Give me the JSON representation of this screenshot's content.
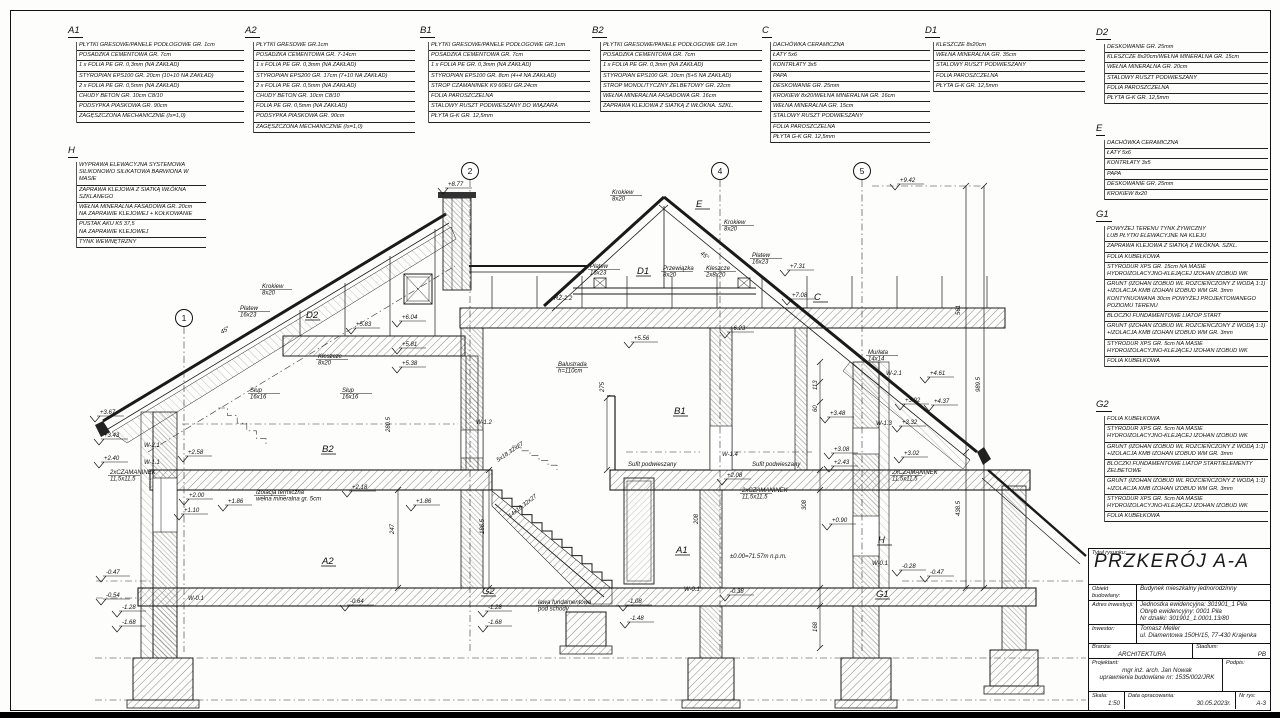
{
  "sheet": {
    "type": "architectural-section-drawing"
  },
  "blocks": [
    {
      "id": "A1",
      "x": 68,
      "y": 26,
      "w": 176,
      "rows": [
        [
          "PŁYTKI GRESOWE/PANELE PODŁOGOWE GR. 1cm"
        ],
        [
          "POSADZKA CEMENTOWA GR. 7cm"
        ],
        [
          "1 x FOLIA PE GR. 0,3mm (NA ZAKŁAD)"
        ],
        [
          "STYROPIAN EPS100 GR. 20cm (10+10 NA ZAKŁAD)"
        ],
        [
          "2 x FOLIA PE GR. 0,5mm (NA ZAKŁAD)"
        ],
        [
          "CHUDY BETON GR. 10cm C8/10"
        ],
        [
          "PODSYPKA PIASKOWA GR. 90cm"
        ],
        [
          "ZAGĘSZCZONA MECHANICZNIE (Is=1,0)"
        ]
      ]
    },
    {
      "id": "A2",
      "x": 245,
      "y": 26,
      "w": 170,
      "rows": [
        [
          "PŁYTKI GRESOWE GR.1cm"
        ],
        [
          "POSADZKA CEMENTOWA GR. 7-14cm"
        ],
        [
          "1 x FOLIA PE GR. 0,3mm (NA ZAKŁAD)"
        ],
        [
          "STYROPIAN EPS200 GR. 17cm (7+10 NA ZAKŁAD)"
        ],
        [
          "2 x FOLIA PE GR. 0,5mm (NA ZAKŁAD)"
        ],
        [
          "CHUDY BETON GR. 10cm C8/10"
        ],
        [
          "FOLIA PE GR. 0,5mm (NA ZAKŁAD)"
        ],
        [
          "PODSYPKA PIASKOWA GR. 90cm"
        ],
        [
          "ZAGĘSZCZONA MECHANICZNIE (Is=1,0)"
        ]
      ]
    },
    {
      "id": "B1",
      "x": 420,
      "y": 26,
      "w": 170,
      "rows": [
        [
          "PŁYTKI GRESOWE/PANELE PODŁOGOWE GR.1cm"
        ],
        [
          "POSADZKA CEMENTOWA GR. 7cm"
        ],
        [
          "1 x FOLIA PE GR. 0,3mm (NA ZAKŁAD)"
        ],
        [
          "STYROPIAN EPS100 GR. 8cm (4+4 NA ZAKŁAD)"
        ],
        [
          "STROP CZAMANINEK K9 60EU GR.24cm"
        ],
        [
          "FOLIA PAROSZCZELNA"
        ],
        [
          "STALOWY RUSZT PODWIESZANY DO WIĄZARA"
        ],
        [
          "PŁYTA G-K GR. 12,5mm"
        ]
      ]
    },
    {
      "id": "B2",
      "x": 592,
      "y": 26,
      "w": 170,
      "rows": [
        [
          "PŁYTKI GRESOWE/PANELE PODŁOGOWE GR.1cm"
        ],
        [
          "POSADZKA CEMENTOWA GR. 7cm"
        ],
        [
          "1 x FOLIA PE GR. 0,3mm (NA ZAKŁAD)"
        ],
        [
          "STYROPIAN EPS100 GR. 10cm (5+5 NA ZAKŁAD)"
        ],
        [
          "STROP MONOLITYCZNY ŻELBETOWY GR. 22cm"
        ],
        [
          "WEŁNA MINERALNA FASADOWA GR. 16cm"
        ],
        [
          "ZAPRAWA KLEJOWA Z SIATKĄ Z WŁÓKNA. SZKL."
        ]
      ]
    },
    {
      "id": "C",
      "x": 762,
      "y": 26,
      "w": 168,
      "rows": [
        [
          "DACHÓWKA CERAMICZNA"
        ],
        [
          "ŁATY 5x6"
        ],
        [
          "KONTRŁATY 3x5"
        ],
        [
          "PAPA"
        ],
        [
          "DESKOWANIE GR. 25mm"
        ],
        [
          "KROKIEW 8x20/WEŁNA MINERALNA GR. 16cm"
        ],
        [
          "WEŁNA MINERALNA GR. 15cm"
        ],
        [
          "STALOWY RUSZT PODWIESZANY"
        ],
        [
          "FOLIA PAROSZCZELNA"
        ],
        [
          "PŁYTA G-K GR. 12,5mm"
        ]
      ]
    },
    {
      "id": "D1",
      "x": 925,
      "y": 26,
      "w": 160,
      "rows": [
        [
          "KLESZCZE 8x20cm"
        ],
        [
          "WEŁNA MINERALNA GR. 35cm"
        ],
        [
          "STALOWY RUSZT PODWIESZANY"
        ],
        [
          "FOLIA PAROSZCZELNA"
        ],
        [
          "PŁYTA G-K GR. 12,5mm"
        ]
      ]
    },
    {
      "id": "D2",
      "x": 1096,
      "y": 28,
      "w": 172,
      "rows": [
        [
          "DESKOWANIE GR. 25mm"
        ],
        [
          "KLESZCZE 8x20cm/WEŁNA MINERALNA GR. 15cm"
        ],
        [
          "WEŁNA MINERALNA GR. 20cm"
        ],
        [
          "STALOWY RUSZT PODWIESZANY"
        ],
        [
          "FOLIA PAROSZCZELNA"
        ],
        [
          "PŁYTA G-K GR. 12,5mm"
        ]
      ]
    },
    {
      "id": "E",
      "x": 1096,
      "y": 124,
      "w": 172,
      "rows": [
        [
          "DACHÓWKA CERAMICZNA"
        ],
        [
          "ŁATY 5x6"
        ],
        [
          "KONTRŁATY 3x5"
        ],
        [
          "PAPA"
        ],
        [
          "DESKOWANIE GR. 25mm"
        ],
        [
          "KROKIEW 8x20"
        ]
      ]
    },
    {
      "id": "G1",
      "x": 1096,
      "y": 210,
      "w": 172,
      "rows": [
        [
          "POWYŻEJ TERENU TYNK ŻYWICZNY",
          "LUB PŁYTKI ELEWACYJNE NA KLEJU"
        ],
        [
          "ZAPRAWA KLEJOWA Z SIATKĄ Z WŁÓKNA. SZKL."
        ],
        [
          "FOLIA KUBEŁKOWA"
        ],
        [
          "STYRODUR XPS GR. 15cm NA MASIE",
          "HYDROIZOLACYJNO-KLEJĄCEJ IZOHAN IZOBUD WK"
        ],
        [
          "GRUNT (IZOHAN IZOBUD WL ROZCIEŃCZONY Z WODĄ 1:1)",
          "+IZOLACJA KMB IZOHAN IZOBUD WM  GR. 3mm",
          "KONTYNUOWANA 30cm POWYŻEJ PROJEKTOWANEGO",
          "POZIOMU TERENU"
        ],
        [
          "BLOCZKI FUNDAMENTOWE LIATOP START"
        ],
        [
          "GRUNT (IZOHAN IZOBUD WL ROZCIEŃCZONY Z WODĄ 1:1)",
          "+IZOLACJA KMB IZOHAN IZOBUD WM  GR. 3mm"
        ],
        [
          "STYRODUR XPS GR. 5cm NA MASIE",
          "HYDROIZOLACYJNO-KLEJĄCEJ IZOHAN IZOBUD WK"
        ],
        [
          "FOLIA KUBEŁKOWA"
        ]
      ]
    },
    {
      "id": "G2",
      "x": 1096,
      "y": 400,
      "w": 172,
      "rows": [
        [
          "FOLIA KUBEŁKOWA"
        ],
        [
          "STYRODUR XPS GR. 5cm NA MASIE",
          "HYDROIZOLACYJNO-KLEJĄCEJ IZOHAN IZOBUD WK"
        ],
        [
          "GRUNT (IZOHAN IZOBUD WL ROZCIEŃCZONY Z WODĄ 1:1)",
          "+IZOLACJA KMB IZOHAN IZOBUD WM  GR. 3mm"
        ],
        [
          "BLOCZKI FUNDAMENTOWE LIATOP START/ELEMENTY ŻELBETOWE"
        ],
        [
          "GRUNT (IZOHAN IZOBUD WL ROZCIEŃCZONY Z WODĄ 1:1)",
          "+IZOLACJA KMB IZOHAN IZOBUD WM  GR. 3mm"
        ],
        [
          "STYRODUR XPS GR. 5cm NA MASIE",
          "HYDROIZOLACYJNO-KLEJĄCEJ IZOHAN IZOBUD WK"
        ],
        [
          "FOLIA KUBEŁKOWA"
        ]
      ]
    },
    {
      "id": "H",
      "x": 68,
      "y": 146,
      "w": 138,
      "rows": [
        [
          "WYPRAWA ELEWACYJNA SYSTEMOWA",
          "SILIKONOWO SILIKATOWA BARWIONA W MASIE"
        ],
        [
          "ZAPRAWA KLEJOWA Z SIATKĄ WŁÓKNA SZKLANEGO"
        ],
        [
          "WEŁNA MINERALNA FASADOWA GR. 20cm",
          "NA ZAPRAWIE KLEJOWEJ + KOŁKOWANIE"
        ],
        [
          "PUSTAK AKU K5 37,5",
          "NA ZAPRAWIE KLEJOWEJ"
        ],
        [
          "TYNK WEWNĘTRZNY"
        ]
      ]
    }
  ],
  "titleblock": {
    "drawing_title_label": "Tytuł rysunku:",
    "drawing_title": "PRZKERÓJ A-A",
    "object_label": "Obiekt budowlany:",
    "object_value": "Budynek mieszkalny jednorodzinny",
    "address_label": "Adres inwestycji:",
    "address_lines": [
      "Jednostka ewidencyjna: 301901_1 Piła",
      "Obręb ewidencyjny: 0001 Piła",
      "Nr działki: 301901_1.0001.13/80"
    ],
    "investor_label": "Inwestor:",
    "investor_lines": [
      "Tomasz Meller",
      "ul. Diamentowa 150H/15, 77-430 Krajenka"
    ],
    "branch_label": "Branża:",
    "branch_value": "ARCHITEKTURA",
    "stage_label": "Stadium:",
    "stage_value": "PB",
    "designer_label": "Projektant:",
    "designer_lines": [
      "mgr inż. arch. Jan Nowak",
      "uprawnienia budowlane nr: 1535/002/JRK"
    ],
    "signature_label": "Podpis:",
    "scale_label": "Skala:",
    "scale_value": "1:50",
    "date_label": "Data opracowania:",
    "date_value": "30.05.2023r.",
    "sheet_no_label": "Nr rys:",
    "sheet_no_value": "A-3"
  },
  "drawing": {
    "grid": [
      {
        "n": "1",
        "x": 184,
        "y": 318
      },
      {
        "n": "2",
        "x": 470,
        "y": 171
      },
      {
        "n": "4",
        "x": 720,
        "y": 171
      },
      {
        "n": "5",
        "x": 862,
        "y": 171
      }
    ],
    "labels": [
      {
        "t": "+9.42",
        "x": 900,
        "y": 182,
        "e": 1
      },
      {
        "t": "+8.77",
        "x": 448,
        "y": 186,
        "e": 1
      },
      {
        "l": [
          "Krokiew",
          "8x20"
        ],
        "x": 262,
        "y": 288
      },
      {
        "l": [
          "Płatew",
          "16x23"
        ],
        "x": 240,
        "y": 310
      },
      {
        "t": "45°",
        "x": 222,
        "y": 334,
        "r": -31
      },
      {
        "t": "D2",
        "x": 306,
        "y": 318,
        "b": 1
      },
      {
        "t": "+6.04",
        "x": 402,
        "y": 319,
        "e": 1
      },
      {
        "t": "+5.83",
        "x": 356,
        "y": 326,
        "e": 1
      },
      {
        "t": "+5.81",
        "x": 402,
        "y": 346,
        "e": 1
      },
      {
        "t": "+5.38",
        "x": 402,
        "y": 365,
        "e": 1
      },
      {
        "l": [
          "Kleszcze",
          "8x20"
        ],
        "x": 318,
        "y": 358
      },
      {
        "l": [
          "Słup",
          "16x16"
        ],
        "x": 250,
        "y": 392
      },
      {
        "l": [
          "Słup",
          "16x16"
        ],
        "x": 342,
        "y": 392
      },
      {
        "t": "280.5",
        "x": 390,
        "y": 432,
        "r": -90
      },
      {
        "t": "W-1.2",
        "x": 476,
        "y": 424
      },
      {
        "l": [
          "Krokiew",
          "8x20"
        ],
        "x": 612,
        "y": 194
      },
      {
        "t": "E",
        "x": 696,
        "y": 207,
        "b": 1
      },
      {
        "l": [
          "Krokiew",
          "8x20"
        ],
        "x": 724,
        "y": 224
      },
      {
        "t": "45°",
        "x": 700,
        "y": 254,
        "r": 39
      },
      {
        "l": [
          "Płatew",
          "16x23"
        ],
        "x": 590,
        "y": 268
      },
      {
        "t": "D1",
        "x": 637,
        "y": 274,
        "b": 1
      },
      {
        "l": [
          "Przewiązka",
          "8x20"
        ],
        "x": 663,
        "y": 270
      },
      {
        "l": [
          "Kleszcze",
          "2x8x20"
        ],
        "x": 706,
        "y": 270
      },
      {
        "l": [
          "Płatew",
          "16x23"
        ],
        "x": 752,
        "y": 257
      },
      {
        "t": "RŻ-2.2",
        "x": 554,
        "y": 300
      },
      {
        "t": "C",
        "x": 814,
        "y": 300,
        "b": 1
      },
      {
        "t": "+7.31",
        "x": 790,
        "y": 268,
        "e": 1
      },
      {
        "t": "+7.08",
        "x": 792,
        "y": 297,
        "e": 1
      },
      {
        "t": "+6.23",
        "x": 730,
        "y": 330,
        "e": 1
      },
      {
        "t": "+5.56",
        "x": 634,
        "y": 340,
        "e": 1
      },
      {
        "l": [
          "Murłata",
          "14x14"
        ],
        "x": 868,
        "y": 354
      },
      {
        "t": "W-2.1",
        "x": 886,
        "y": 375
      },
      {
        "t": "+4.61",
        "x": 930,
        "y": 375,
        "e": 1
      },
      {
        "t": "+3.92",
        "x": 905,
        "y": 402,
        "e": 1
      },
      {
        "t": "+4.37",
        "x": 934,
        "y": 403,
        "e": 1
      },
      {
        "t": "561",
        "x": 960,
        "y": 315,
        "r": -90
      },
      {
        "t": "989.5",
        "x": 980,
        "y": 392,
        "r": -90
      },
      {
        "t": "438.5",
        "x": 960,
        "y": 516,
        "r": -90
      },
      {
        "l": [
          "Balustrada",
          "h=110cm"
        ],
        "x": 558,
        "y": 366
      },
      {
        "t": "275",
        "x": 604,
        "y": 392,
        "r": -90
      },
      {
        "t": "B1",
        "x": 674,
        "y": 414,
        "b": 1
      },
      {
        "t": "+3.48",
        "x": 830,
        "y": 415,
        "e": 1
      },
      {
        "t": "W-1.3",
        "x": 876,
        "y": 425
      },
      {
        "t": "+3.32",
        "x": 902,
        "y": 424,
        "e": 1
      },
      {
        "t": "+3.02",
        "x": 904,
        "y": 455,
        "e": 1
      },
      {
        "t": "+3.08",
        "x": 834,
        "y": 451,
        "e": 1
      },
      {
        "t": "+2.43",
        "x": 834,
        "y": 464,
        "e": 1
      },
      {
        "l": [
          "2xCZAMANINEK",
          "11,5x11,5"
        ],
        "x": 892,
        "y": 474
      },
      {
        "t": "+0.90",
        "x": 832,
        "y": 522,
        "e": 1
      },
      {
        "t": "H",
        "x": 878,
        "y": 543,
        "b": 1
      },
      {
        "t": "W-0.1",
        "x": 872,
        "y": 565
      },
      {
        "t": "-0.28",
        "x": 902,
        "y": 568,
        "e": 1
      },
      {
        "t": "-0.47",
        "x": 930,
        "y": 574,
        "e": 1
      },
      {
        "t": "G1",
        "x": 876,
        "y": 597,
        "b": 1
      },
      {
        "t": "+3.67",
        "x": 100,
        "y": 414,
        "e": 1
      },
      {
        "t": "+3.43",
        "x": 104,
        "y": 437,
        "e": 1
      },
      {
        "t": "W-2.1",
        "x": 144,
        "y": 447
      },
      {
        "t": "+2.40",
        "x": 104,
        "y": 460,
        "e": 1
      },
      {
        "t": "W-1.1",
        "x": 144,
        "y": 464
      },
      {
        "l": [
          "2xCZAMANINEK",
          "11,5x11,5"
        ],
        "x": 110,
        "y": 474
      },
      {
        "t": "+2.58",
        "x": 188,
        "y": 454,
        "e": 1
      },
      {
        "t": "+2.00",
        "x": 189,
        "y": 497,
        "e": 1
      },
      {
        "t": "+1.10",
        "x": 184,
        "y": 512,
        "e": 1
      },
      {
        "t": "+1.86",
        "x": 228,
        "y": 503,
        "e": 1
      },
      {
        "t": "+1.86",
        "x": 416,
        "y": 503,
        "e": 1
      },
      {
        "t": "B2",
        "x": 322,
        "y": 452,
        "b": 1
      },
      {
        "l": [
          "Izolacja termiczna",
          "wełna mineralna gr. 5cm"
        ],
        "x": 256,
        "y": 494
      },
      {
        "t": "+2.18",
        "x": 352,
        "y": 489,
        "e": 1
      },
      {
        "t": "247",
        "x": 394,
        "y": 534,
        "r": -90
      },
      {
        "t": "186.5",
        "x": 484,
        "y": 534,
        "r": -90
      },
      {
        "t": "A2",
        "x": 322,
        "y": 564,
        "b": 1
      },
      {
        "t": "W-0.1",
        "x": 188,
        "y": 600
      },
      {
        "t": "-0.64",
        "x": 350,
        "y": 603,
        "e": 1
      },
      {
        "t": "-0.47",
        "x": 106,
        "y": 574,
        "e": 1
      },
      {
        "t": "-0.54",
        "x": 106,
        "y": 597,
        "e": 1
      },
      {
        "t": "-1.28",
        "x": 122,
        "y": 609,
        "e": 1
      },
      {
        "t": "-1.68",
        "x": 122,
        "y": 624,
        "e": 1
      },
      {
        "t": "G2",
        "x": 482,
        "y": 594,
        "b": 1
      },
      {
        "t": "-1.28",
        "x": 488,
        "y": 609,
        "e": 1
      },
      {
        "t": "-1.68",
        "x": 488,
        "y": 624,
        "e": 1
      },
      {
        "t": "5x18,32x27",
        "x": 498,
        "y": 462,
        "r": -34
      },
      {
        "t": "14x18,32x27",
        "x": 510,
        "y": 518,
        "r": -38
      },
      {
        "t": "Sufit podwieszany",
        "x": 628,
        "y": 466
      },
      {
        "t": "W-1.4",
        "x": 722,
        "y": 456
      },
      {
        "t": "Sufit podwieszany",
        "x": 752,
        "y": 466
      },
      {
        "t": "+2.08",
        "x": 727,
        "y": 477,
        "e": 1
      },
      {
        "l": [
          "2xCZAMANINEK",
          "11,5x11,5"
        ],
        "x": 742,
        "y": 492
      },
      {
        "t": "A1",
        "x": 676,
        "y": 553,
        "b": 1
      },
      {
        "t": "±0.00=71.57m n.p.m.",
        "x": 730,
        "y": 558
      },
      {
        "l": [
          "ława fundamentowa",
          "pod schody"
        ],
        "x": 538,
        "y": 604
      },
      {
        "t": "-1.08",
        "x": 628,
        "y": 603,
        "e": 1
      },
      {
        "t": "-1.48",
        "x": 630,
        "y": 620,
        "e": 1
      },
      {
        "t": "W-0.1",
        "x": 684,
        "y": 591
      },
      {
        "t": "-0.38",
        "x": 730,
        "y": 593,
        "e": 1
      },
      {
        "t": "113",
        "x": 817,
        "y": 390,
        "r": -90
      },
      {
        "t": "60",
        "x": 817,
        "y": 412,
        "r": -90
      },
      {
        "t": "308",
        "x": 806,
        "y": 510,
        "r": -90
      },
      {
        "t": "208",
        "x": 698,
        "y": 524,
        "r": -90
      },
      {
        "t": "168",
        "x": 817,
        "y": 632,
        "r": -90
      }
    ]
  }
}
